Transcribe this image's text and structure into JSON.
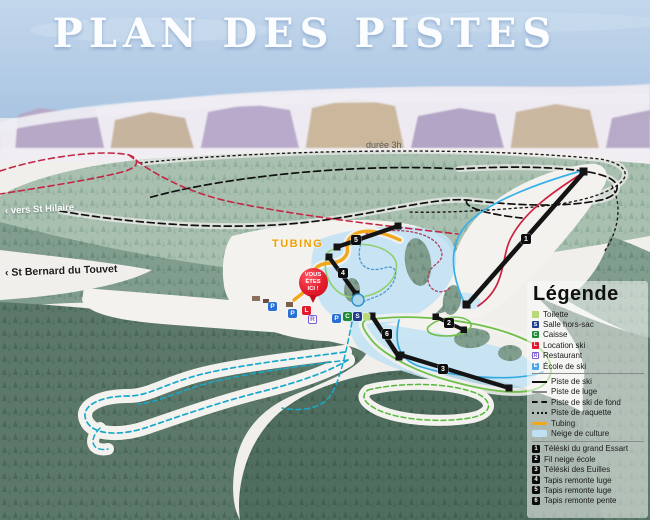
{
  "title": "PLAN DES PISTES",
  "map_labels": {
    "duration": "durée 3h",
    "tubing": "TUBING",
    "vers_st_hilaire": "‹ vers St Hilaire",
    "st_bernard": "‹ St Bernard du Touvet",
    "you_are_here": {
      "line1": "VOUS",
      "line2": "ÊTES",
      "line3": "ICI !"
    }
  },
  "map": {
    "facilities": [
      {
        "letter": "P",
        "name": "Parking"
      },
      {
        "letter": "P",
        "name": "Parking"
      },
      {
        "letter": "L",
        "name": "Location ski"
      },
      {
        "letter": "R",
        "name": "Restaurant"
      },
      {
        "letter": "P",
        "name": "Parking"
      },
      {
        "letter": "C",
        "name": "Caisse"
      },
      {
        "letter": "S",
        "name": "Salle hors-sac"
      },
      {
        "letter": "",
        "name": "Toilette"
      }
    ],
    "lift_numbers": [
      "1",
      "2",
      "3",
      "4",
      "5",
      "6"
    ]
  },
  "legend": {
    "title": "Légende",
    "facilities": [
      {
        "letter": "",
        "label": "Toilette",
        "color": "#b9d877"
      },
      {
        "letter": "S",
        "label": "Salle hors-sac",
        "color": "#1f3d8a"
      },
      {
        "letter": "C",
        "label": "Caisse",
        "color": "#1e8a34"
      },
      {
        "letter": "L",
        "label": "Location ski",
        "color": "#e31b2d"
      },
      {
        "letter": "R",
        "label": "Restaurant",
        "color": "#7b5bd0"
      },
      {
        "letter": "E",
        "label": "École de ski",
        "color": "#4aa8e8"
      }
    ],
    "trails": [
      {
        "label": "Piste de ski",
        "style": "solid-black"
      },
      {
        "label": "Piste de luge",
        "style": "solid-gray"
      },
      {
        "label": "Piste de ski de fond",
        "style": "dashed-black"
      },
      {
        "label": "Piste de raquette",
        "style": "dotted-black"
      },
      {
        "label": "Tubing",
        "style": "tubing-orange"
      },
      {
        "label": "Neige de culture",
        "style": "snow-patch"
      }
    ],
    "lifts": [
      {
        "num": "1",
        "label": "Téléski du grand Essart"
      },
      {
        "num": "2",
        "label": "Fil neige école"
      },
      {
        "num": "3",
        "label": "Téléski des Euilles"
      },
      {
        "num": "4",
        "label": "Tapis remonte luge"
      },
      {
        "num": "5",
        "label": "Tapis remonte luge"
      },
      {
        "num": "6",
        "label": "Tapis remonte pente"
      }
    ]
  },
  "colors": {
    "sky": "#b8cee8",
    "tubing": "#f2a71b",
    "you_are_here_pin": "#e51c2e",
    "piste_red": "#c82343",
    "piste_blue": "#30a8e0",
    "trail_cyan": "#18a8cc",
    "trail_green": "#63bb45",
    "snow_culture": "#bfe0f3"
  }
}
